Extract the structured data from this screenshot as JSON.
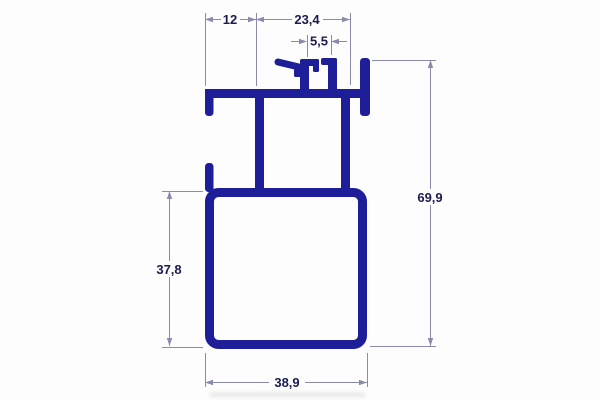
{
  "drawing": {
    "type": "aluminum-profile-cross-section",
    "labels": {
      "dim_top_left": "12",
      "dim_top_right": "23,4",
      "dim_slot": "5,5",
      "dim_height_overall": "69,9",
      "dim_height_body": "37,8",
      "dim_width_body": "38,9"
    },
    "colors": {
      "profile": "#1e1e99",
      "dimension_line": "#8a8aac",
      "dimension_text": "#1b1b4e",
      "background": "#fdfdfd"
    }
  }
}
